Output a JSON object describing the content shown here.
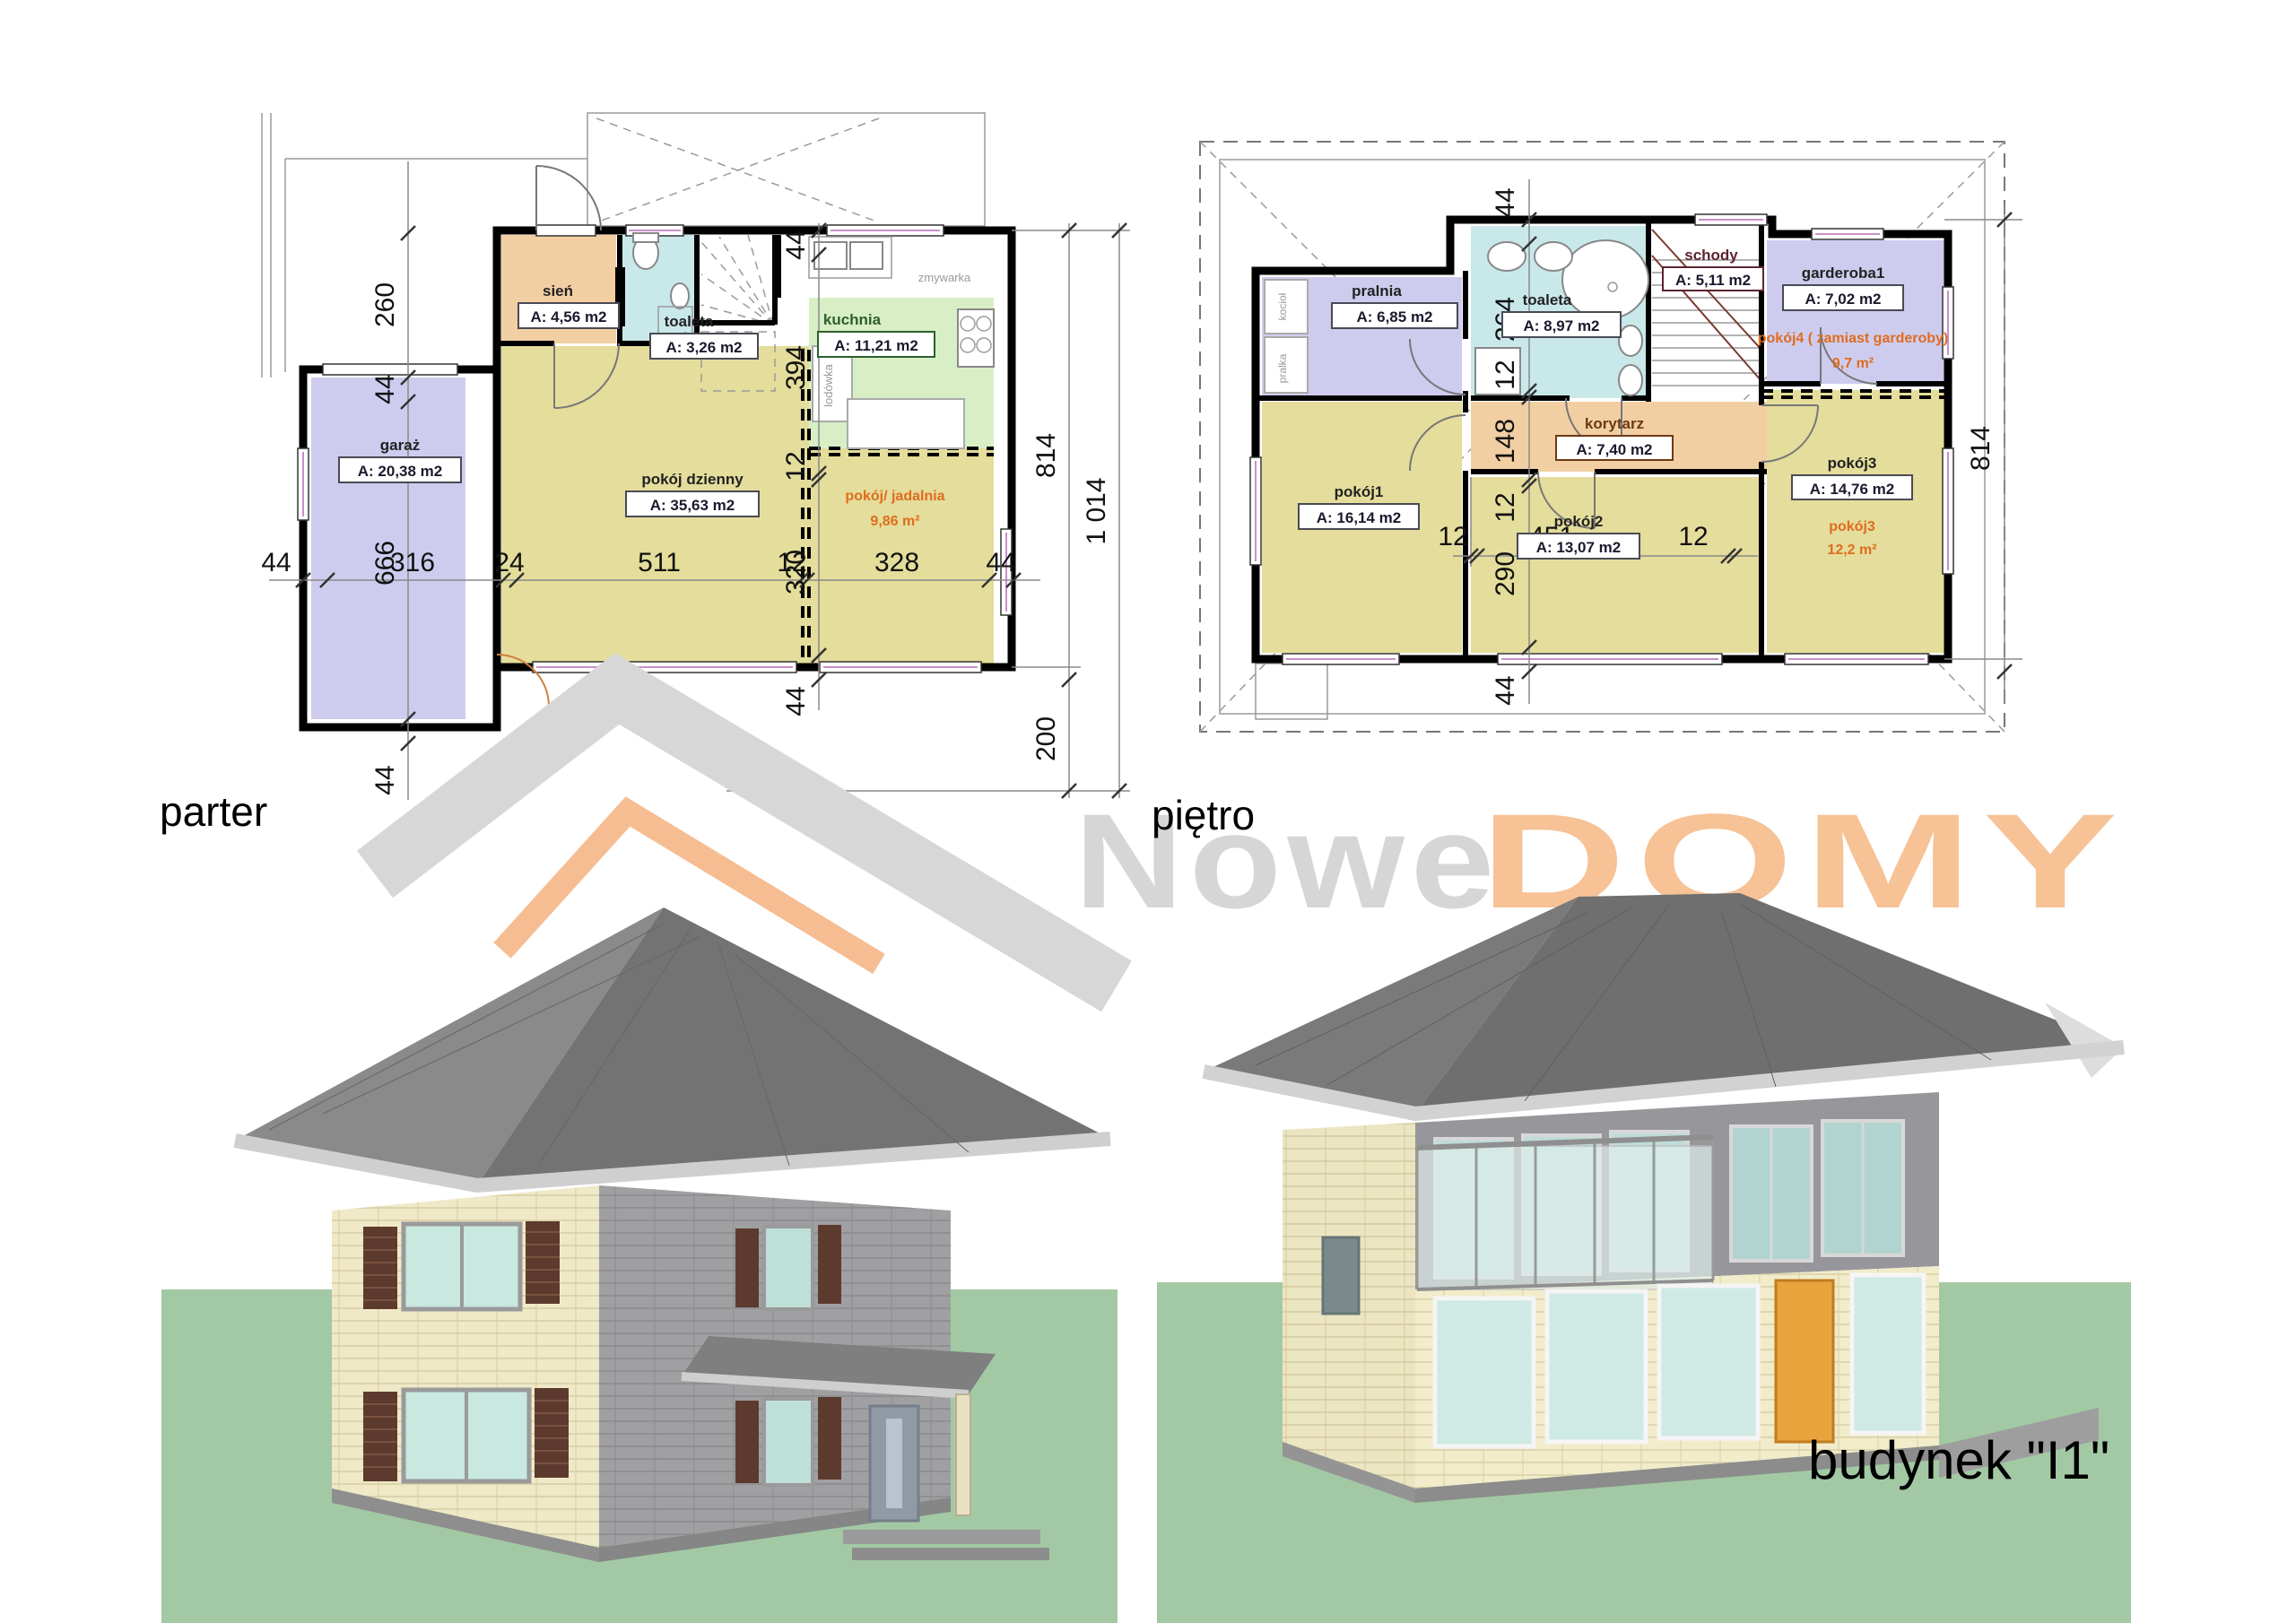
{
  "document": {
    "caption_parter": "parter",
    "caption_pietro": "piętro",
    "building_label": "budynek \"I1\"",
    "logo": {
      "part1": "Nowe",
      "part2": "DOMY"
    }
  },
  "palette": {
    "room_khaki": "#e4dd9b",
    "room_lavender": "#ceccee",
    "room_cyan": "#c9e8ea",
    "room_green": "#d8efc6",
    "room_orange": "#f2cfa3",
    "accent_orange_text": "#e06c1f",
    "logo_gray": "#d6d6d6",
    "logo_orange": "#f6c296"
  },
  "parter": {
    "rooms": {
      "sien": {
        "name": "sień",
        "area": "A: 4,56 m2"
      },
      "toaleta": {
        "name": "toaleta",
        "area": "A: 3,26 m2"
      },
      "kuchnia": {
        "name": "kuchnia",
        "area": "A: 11,21 m2"
      },
      "pokoj_dzienny": {
        "name": "pokój dzienny",
        "area": "A: 35,63 m2"
      },
      "pokoj_jadalnia": {
        "name": "pokój/ jadalnia",
        "area": "9,86 m²"
      },
      "garaz": {
        "name": "garaż",
        "area": "A: 20,38 m2"
      }
    },
    "equipment": {
      "zmywarka": "zmywarka",
      "lodowka": "lodówka"
    },
    "dims": {
      "d260": "260",
      "d44a": "44",
      "row44l": "44",
      "row316": "316",
      "row24": "24",
      "row511": "511",
      "row12": "12",
      "row328": "328",
      "row44r": "44",
      "d666": "666",
      "d44b": "44",
      "col44t": "44",
      "col394": "394",
      "col12": "12",
      "col320": "320",
      "col44b": "44",
      "d814": "814",
      "d1014": "1 014",
      "d200": "200"
    }
  },
  "pietro": {
    "rooms": {
      "pralnia": {
        "name": "pralnia",
        "area": "A: 6,85 m2"
      },
      "toaleta": {
        "name": "toaleta",
        "area": "A: 8,97 m2"
      },
      "schody": {
        "name": "schody",
        "area": "A: 5,11 m2"
      },
      "garderoba1": {
        "name": "garderoba1",
        "area": "A: 7,02 m2"
      },
      "pokoj4": {
        "name": "pokój4 ( zamiast garderoby)",
        "area": "9,7 m²"
      },
      "korytarz": {
        "name": "korytarz",
        "area": "A: 7,40 m2"
      },
      "pokoj1": {
        "name": "pokój1",
        "area": "A: 16,14 m2"
      },
      "pokoj2": {
        "name": "pokój2",
        "area": "A: 13,07 m2"
      },
      "pokoj3": {
        "name": "pokój3",
        "area": "A: 14,76 m2"
      },
      "pokoj3_alt": {
        "name": "pokój3",
        "area": "12,2 m²"
      }
    },
    "equipment": {
      "kociol": "kocioł",
      "pralka": "pralka"
    },
    "dims": {
      "top44": "44",
      "c264": "264",
      "c12a": "12",
      "c148": "148",
      "c12b": "12",
      "c290": "290",
      "c44": "44",
      "r12a": "12",
      "r451": "451",
      "r12b": "12",
      "d814": "814"
    }
  }
}
